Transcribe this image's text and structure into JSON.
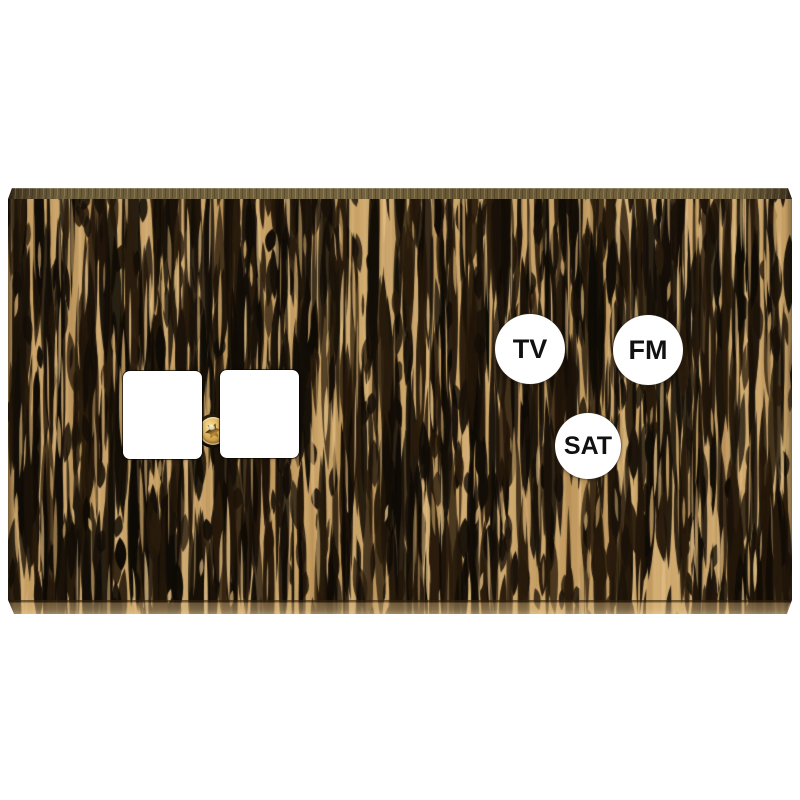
{
  "plate": {
    "labels": {
      "tv": "TV",
      "fm": "FM",
      "sat": "SAT"
    },
    "colors": {
      "background": "#ffffff",
      "wood_light": "#cda66a",
      "wood_highlight": "#dfbc82",
      "wood_dark": "#160f08",
      "edge_bronze": "#6b5c3a",
      "screw_brass": "#d9ae55",
      "cutout_white": "#ffffff",
      "label_text": "#111111"
    }
  }
}
